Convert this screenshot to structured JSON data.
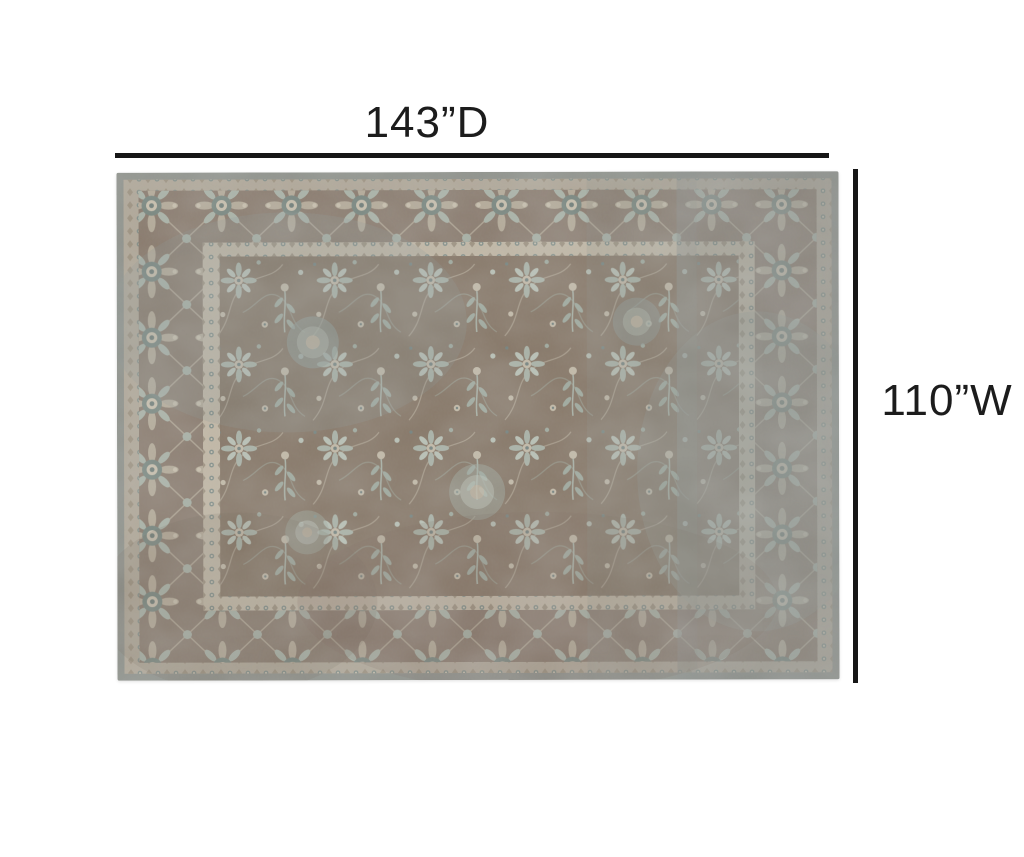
{
  "page": {
    "background": "#ffffff"
  },
  "annotations": {
    "depth": {
      "label": "143”D"
    },
    "width": {
      "label": "110”W"
    },
    "line_color": "#161616",
    "text_color": "#1c1c1c"
  },
  "rug": {
    "description": "Distressed vintage oriental rug, all-over floral field with palmette border",
    "colors": {
      "selvedge": "#8e918b",
      "minor_band": "#b1a899",
      "main_border": "#8a7b6e",
      "guard_band": "#c2b8a6",
      "field": "#857565",
      "motif_beige": "#c3baa8",
      "motif_sage": "#a9b2a7",
      "motif_slate": "#74827f",
      "distress_wash": "#8e9894"
    }
  }
}
